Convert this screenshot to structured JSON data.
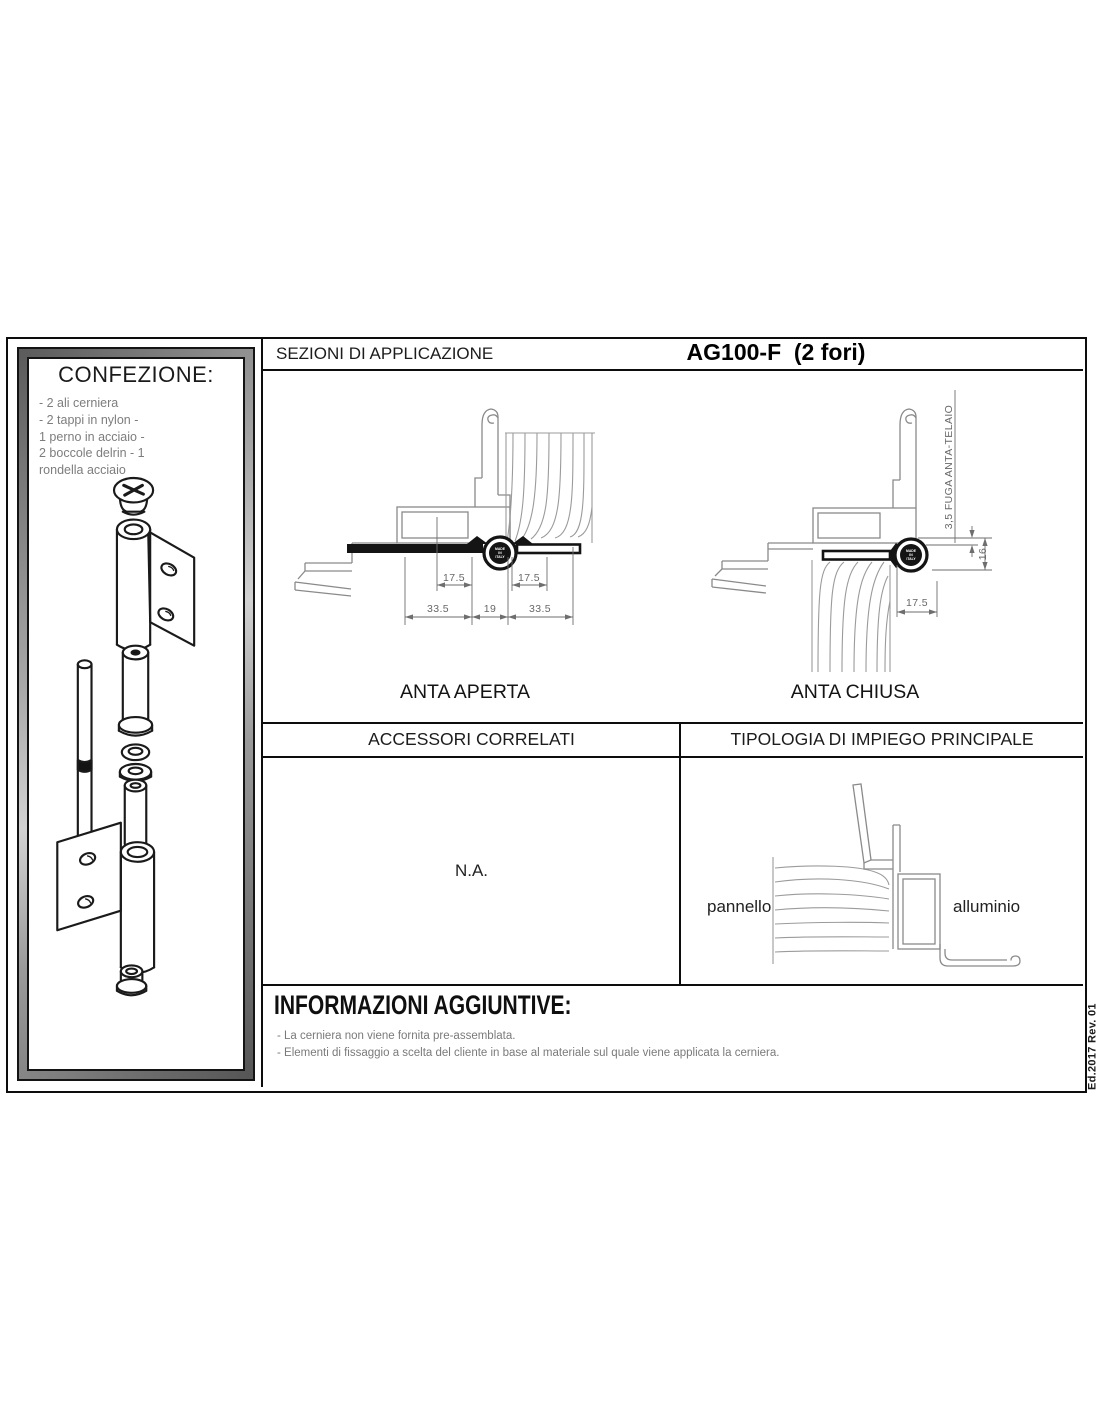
{
  "confezione": {
    "title": "CONFEZIONE:",
    "items": [
      "- 2 ali cerniera",
      "- 2 tappi in nylon -",
      "1 perno in acciaio -",
      "2 boccole delrin - 1",
      "rondella acciaio"
    ]
  },
  "header": {
    "section_title": "SEZIONI DI APPLICAZIONE",
    "product_code": "AG100-F  (2 fori)"
  },
  "anta_aperta": {
    "label": "ANTA APERTA",
    "knuckle": [
      "MADE",
      "IN",
      "ITALY"
    ],
    "dim_left_offset": "17.5",
    "dim_right_offset": "17.5",
    "dim_left_width": "33.5",
    "dim_gap": "19",
    "dim_right_width": "33.5"
  },
  "anta_chiusa": {
    "label": "ANTA CHIUSA",
    "knuckle": [
      "MADE",
      "IN",
      "ITALY"
    ],
    "fuga_label": "3,5 FUGA ANTA-TELAIO",
    "dim_height": "16",
    "dim_offset": "17.5"
  },
  "accessori": {
    "header": "ACCESSORI CORRELATI",
    "value": "N.A."
  },
  "tipologia": {
    "header": "TIPOLOGIA DI IMPIEGO PRINCIPALE",
    "left_label": "pannello",
    "right_label": "alluminio"
  },
  "informazioni": {
    "title": "INFORMAZIONI AGGIUNTIVE:",
    "notes": [
      "- La cerniera non viene fornita pre-assemblata.",
      "- Elementi di fissaggio a scelta del cliente in base al materiale sul quale viene applicata la cerniera."
    ]
  },
  "revision": "Ed.2017 Rev. 01",
  "colors": {
    "border": "#0d0d0d",
    "drawing": "#8a8a8a",
    "dim": "#686868",
    "muted_text": "#7a7a7a",
    "frame_gray": "#8f8f8f"
  }
}
